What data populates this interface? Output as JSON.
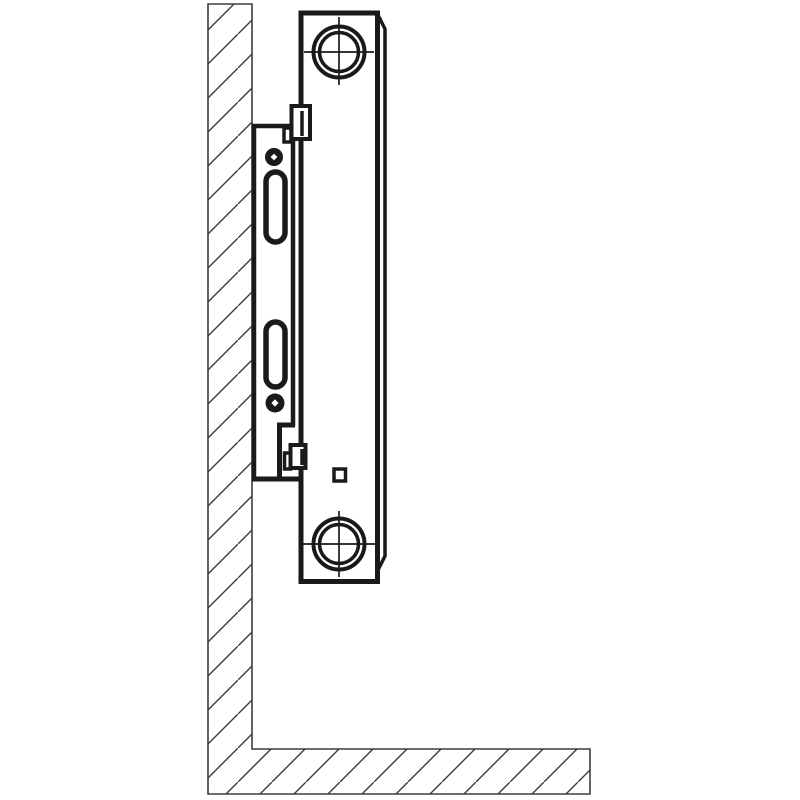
{
  "figure": {
    "description": "Side-view installation diagram of a panel radiator hung on a wall-mounted bracket above the floor",
    "view": "side section",
    "text_labels": []
  },
  "colors": {
    "background": "#ffffff",
    "line": "#1a1a1a",
    "hatch_line": "#3d3d3d",
    "outline": "#3d3d3d"
  },
  "components": {
    "wall": "hatched wall section (vertical)",
    "floor": "hatched floor section (horizontal)",
    "bracket": "mounting bracket plate with two elongated slots, two screw holes, upper hook and lower hook",
    "radiator": "panel radiator side profile with top connection boss, bottom connection boss and small vent square"
  }
}
